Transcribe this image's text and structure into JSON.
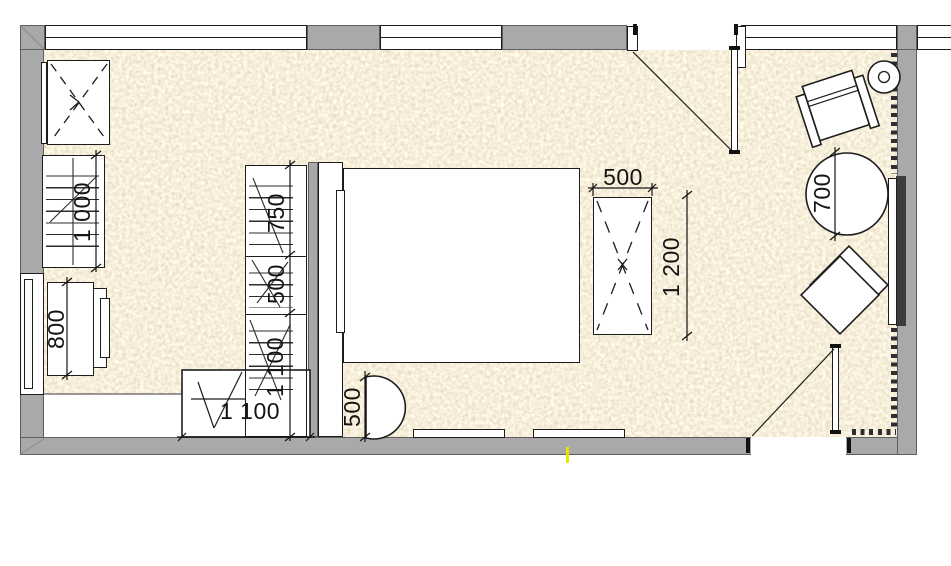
{
  "plan": {
    "type": "bedroom-floor-plan",
    "colors": {
      "wall": "#a9a9a9",
      "carpet_base": "#e6dabb",
      "furniture_fill": "#ffffff",
      "line": "#1d1d1d",
      "tv_panel_dark": "#3c3c3c",
      "outlet_marker": "#e6e600"
    },
    "dimensions": {
      "left_shelving": "1 000",
      "left_dresser": "800",
      "wardrobe_section_top": "750",
      "wardrobe_section_middle": "500",
      "wardrobe_section_bottom": "1 100",
      "desk": "1 100",
      "bedside_table": "500",
      "side_table_width": "500",
      "side_table_length": "1 200",
      "round_table_diameter": "700"
    }
  }
}
